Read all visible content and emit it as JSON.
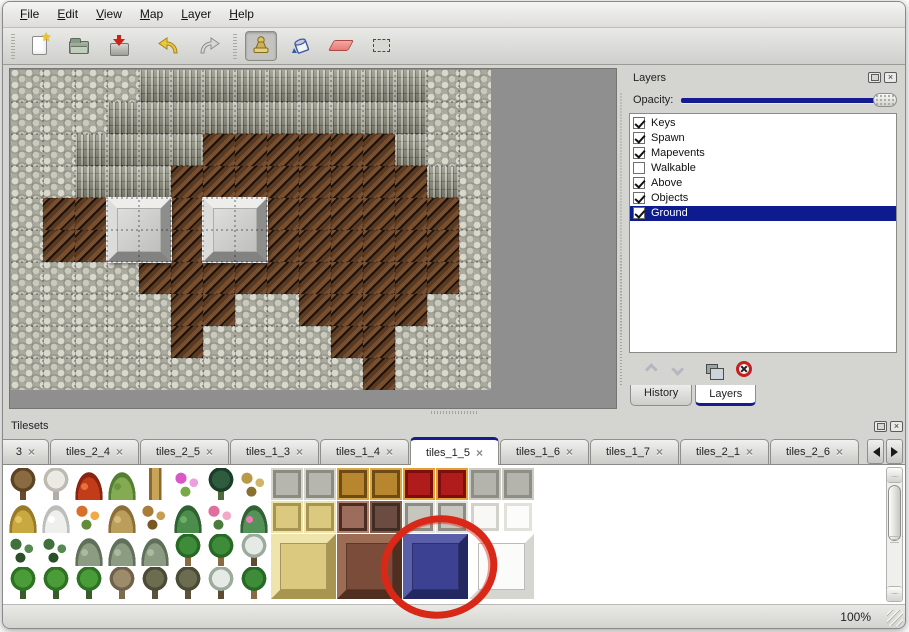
{
  "window": {
    "background": "#d4d4d1",
    "accent": "#141c90"
  },
  "menu": {
    "items": [
      {
        "label": "File"
      },
      {
        "label": "Edit"
      },
      {
        "label": "View"
      },
      {
        "label": "Map"
      },
      {
        "label": "Layer"
      },
      {
        "label": "Help"
      }
    ]
  },
  "toolbar": {
    "buttons": [
      {
        "name": "new"
      },
      {
        "name": "open"
      },
      {
        "name": "save"
      },
      {
        "name": "undo"
      },
      {
        "name": "redo"
      },
      {
        "name": "stamp"
      },
      {
        "name": "fill"
      },
      {
        "name": "eraser"
      },
      {
        "name": "select"
      }
    ],
    "selected": "stamp"
  },
  "map": {
    "tile_size": 32,
    "legend": {
      "s": "scale-rock",
      "c": "cliff-wall",
      "f": "brown-floor"
    },
    "rows": [
      "sssscccccccccss",
      "sssccccccccccss",
      "ssccccffffffcss",
      "sscccffffffffcs",
      "sfffffffffffffs",
      "sfffffffffffffs",
      "ssssffffffffffs",
      "sssssffssffffss",
      "sssssfssssffsss",
      "sssssssssssfsss"
    ],
    "blocks": [
      {
        "x": 96,
        "y": 128
      },
      {
        "x": 192,
        "y": 128
      }
    ],
    "block_color": "#cccccc"
  },
  "layers_panel": {
    "title": "Layers",
    "opacity_label": "Opacity:",
    "opacity_value": 100,
    "layers": [
      {
        "name": "Keys",
        "checked": true,
        "selected": false
      },
      {
        "name": "Spawn",
        "checked": true,
        "selected": false
      },
      {
        "name": "Mapevents",
        "checked": true,
        "selected": false
      },
      {
        "name": "Walkable",
        "checked": false,
        "selected": false
      },
      {
        "name": "Above",
        "checked": true,
        "selected": false
      },
      {
        "name": "Objects",
        "checked": true,
        "selected": false
      },
      {
        "name": "Ground",
        "checked": true,
        "selected": true
      }
    ],
    "buttons": [
      "move-layer-up",
      "move-layer-down",
      "duplicate-layer",
      "delete-layer"
    ],
    "tabs": [
      {
        "label": "History",
        "active": false
      },
      {
        "label": "Layers",
        "active": true
      }
    ]
  },
  "tilesets_panel": {
    "title": "Tilesets",
    "tabs": [
      {
        "label": "3",
        "truncated": true
      },
      {
        "label": "tiles_2_4"
      },
      {
        "label": "tiles_2_5"
      },
      {
        "label": "tiles_1_3"
      },
      {
        "label": "tiles_1_4"
      },
      {
        "label": "tiles_1_5",
        "active": true
      },
      {
        "label": "tiles_1_6"
      },
      {
        "label": "tiles_1_7"
      },
      {
        "label": "tiles_2_1"
      },
      {
        "label": "tiles_2_6"
      }
    ],
    "palette": {
      "tree_bare": [
        "tree",
        "#8a6a40",
        "#5e4424",
        "#6a4a28"
      ],
      "tree_snow": [
        "tree",
        "#eceae4",
        "#bcbab2",
        "#b0aea6"
      ],
      "flower_red": [
        "mound",
        "#c23c1a",
        "#8a2410",
        "#e8703c"
      ],
      "stump_green": [
        "mound",
        "#84aa52",
        "#538030",
        "#6a9440"
      ],
      "trunk_tan": [
        "pillar",
        "#c8a458",
        "#8a6a30",
        "#e0c078"
      ],
      "flowers_pink": [
        "dots",
        "#d858c8",
        "#78aa48",
        "#eda0e0"
      ],
      "palm_dark": [
        "tree",
        "#2e5c3e",
        "#1c3e28",
        "#4c6c3c"
      ],
      "grass_dry": [
        "dots",
        "#b89a48",
        "#8a7030",
        "#d0b468"
      ],
      "mound_hay": [
        "mound",
        "#c8a840",
        "#997a28",
        "#e2c661"
      ],
      "mound_snow": [
        "mound",
        "#efefed",
        "#bdbdb9",
        "#ffffff"
      ],
      "flowers_orange": [
        "dots",
        "#d8702a",
        "#628c3a",
        "#f2a846"
      ],
      "bush_dry": [
        "mound",
        "#bb9d5c",
        "#8c6e36",
        "#d4bc7c"
      ],
      "leaves": [
        "dots",
        "#a87c3a",
        "#7a5626",
        "#c89e52"
      ],
      "lilypad": [
        "mound",
        "#4c8c4c",
        "#2f6232",
        "#6cae64"
      ],
      "rose_bush": [
        "dots",
        "#e06e9e",
        "#4c7c3c",
        "#f2a8c6"
      ],
      "lilypad_flower": [
        "mound",
        "#549258",
        "#306234",
        "#ec7cb4"
      ],
      "sprigs": [
        "dots",
        "#40703c",
        "#2a5028",
        "#568a52"
      ],
      "bush_gray": [
        "mound",
        "#8c9c82",
        "#60705a",
        "#aabaa0"
      ],
      "palm_green": [
        "tree",
        "#3e8c3a",
        "#266a26",
        "#8a6a40"
      ],
      "pine_snow": [
        "tree",
        "#e6eae6",
        "#9cab9c",
        "#5c4c32"
      ],
      "tree_cone": [
        "tree",
        "#4a9c38",
        "#2e7224",
        "#3a5c2c"
      ],
      "tree_twist": [
        "tree",
        "#9c8c6c",
        "#70624a",
        "#7c6c4c"
      ],
      "tree_gnarl": [
        "tree",
        "#6c6c50",
        "#4c4c36",
        "#5c523a"
      ],
      "stone_tile": [
        "flat",
        "#b6b6ae",
        "#8a8c82",
        "#d6d6ce"
      ],
      "wood_table": [
        "flat",
        "#b8862e",
        "#6e4a14",
        "#d8a848"
      ],
      "carpet_red": [
        "flat",
        "#b01c1c",
        "#7c0e0e",
        "#e2a032"
      ],
      "concrete": [
        "flat",
        "#b4b4ac",
        "#8e8e86",
        "#ccccc4"
      ],
      "gold_tile": [
        "flat",
        "#dbc980",
        "#a99552",
        "#efe4ac"
      ],
      "stool": [
        "flat",
        "#9c6c5c",
        "#4c2c20",
        "#b28272"
      ],
      "panel_dark": [
        "flat",
        "#6c4c40",
        "#402c22",
        "#7c5c4c"
      ],
      "pillar_gray": [
        "flat",
        "#c6c6be",
        "#8c8c84",
        "#e6e6de"
      ],
      "white_fringe": [
        "flat",
        "#f8f8f6",
        "#d2d2ca",
        "#ffffff"
      ],
      "white_tile": [
        "flat",
        "#fcfcfa",
        "#e2e2dc",
        "#ffffff"
      ],
      "gold_big": [
        "bevel",
        "#dbc980",
        "#efe4ac",
        "#a99552"
      ],
      "table_big": [
        "bevel",
        "#7c4c3a",
        "#9c6c54",
        "#502e20"
      ],
      "block_blue": [
        "bevel",
        "#3c4192",
        "#5a5faa",
        "#242860"
      ],
      "block_white": [
        "bevel",
        "#fbfbfa",
        "#ffffff",
        "#d6d6d0"
      ]
    },
    "sprites": [
      [
        0,
        0,
        1,
        1,
        "tree_bare"
      ],
      [
        1,
        0,
        1,
        1,
        "tree_snow"
      ],
      [
        2,
        0,
        1,
        1,
        "flower_red"
      ],
      [
        3,
        0,
        1,
        1,
        "stump_green"
      ],
      [
        4,
        0,
        1,
        1,
        "trunk_tan"
      ],
      [
        5,
        0,
        1,
        1,
        "flowers_pink"
      ],
      [
        6,
        0,
        1,
        1,
        "palm_dark"
      ],
      [
        7,
        0,
        1,
        1,
        "grass_dry"
      ],
      [
        8,
        0,
        1,
        1,
        "stone_tile"
      ],
      [
        9,
        0,
        1,
        1,
        "stone_tile"
      ],
      [
        10,
        0,
        1,
        1,
        "wood_table"
      ],
      [
        11,
        0,
        1,
        1,
        "wood_table"
      ],
      [
        12,
        0,
        1,
        1,
        "carpet_red"
      ],
      [
        13,
        0,
        1,
        1,
        "carpet_red"
      ],
      [
        14,
        0,
        1,
        1,
        "concrete"
      ],
      [
        15,
        0,
        1,
        1,
        "concrete"
      ],
      [
        0,
        1,
        1,
        1,
        "mound_hay"
      ],
      [
        1,
        1,
        1,
        1,
        "mound_snow"
      ],
      [
        2,
        1,
        1,
        1,
        "flowers_orange"
      ],
      [
        3,
        1,
        1,
        1,
        "bush_dry"
      ],
      [
        4,
        1,
        1,
        1,
        "leaves"
      ],
      [
        5,
        1,
        1,
        1,
        "lilypad"
      ],
      [
        6,
        1,
        1,
        1,
        "rose_bush"
      ],
      [
        7,
        1,
        1,
        1,
        "lilypad_flower"
      ],
      [
        8,
        1,
        1,
        1,
        "gold_tile"
      ],
      [
        9,
        1,
        1,
        1,
        "gold_tile"
      ],
      [
        10,
        1,
        1,
        1,
        "stool"
      ],
      [
        11,
        1,
        1,
        1,
        "panel_dark"
      ],
      [
        12,
        1,
        1,
        1,
        "pillar_gray"
      ],
      [
        13,
        1,
        1,
        1,
        "pillar_gray"
      ],
      [
        14,
        1,
        1,
        1,
        "white_fringe"
      ],
      [
        15,
        1,
        1,
        1,
        "white_tile"
      ],
      [
        0,
        2,
        1,
        1,
        "sprigs"
      ],
      [
        1,
        2,
        1,
        1,
        "sprigs"
      ],
      [
        2,
        2,
        1,
        1,
        "bush_gray"
      ],
      [
        3,
        2,
        1,
        1,
        "bush_gray"
      ],
      [
        4,
        2,
        1,
        1,
        "bush_gray"
      ],
      [
        5,
        2,
        1,
        1,
        "palm_green"
      ],
      [
        6,
        2,
        1,
        1,
        "palm_green"
      ],
      [
        7,
        2,
        1,
        1,
        "pine_snow"
      ],
      [
        8,
        2,
        2,
        2,
        "gold_big"
      ],
      [
        10,
        2,
        2,
        2,
        "table_big"
      ],
      [
        12,
        2,
        2,
        2,
        "block_blue"
      ],
      [
        14,
        2,
        2,
        2,
        "block_white"
      ],
      [
        0,
        3,
        1,
        1,
        "tree_cone"
      ],
      [
        1,
        3,
        1,
        1,
        "tree_cone"
      ],
      [
        2,
        3,
        1,
        1,
        "tree_cone"
      ],
      [
        3,
        3,
        1,
        1,
        "tree_twist"
      ],
      [
        4,
        3,
        1,
        1,
        "tree_gnarl"
      ],
      [
        5,
        3,
        1,
        1,
        "tree_gnarl"
      ],
      [
        6,
        3,
        1,
        1,
        "pine_snow"
      ],
      [
        7,
        3,
        1,
        1,
        "palm_green"
      ]
    ]
  },
  "annotation": {
    "type": "red-circle",
    "cx": 436,
    "cy": 151,
    "rx": 55,
    "ry": 48,
    "color": "#d82818"
  },
  "status": {
    "zoom_level": "100%"
  }
}
